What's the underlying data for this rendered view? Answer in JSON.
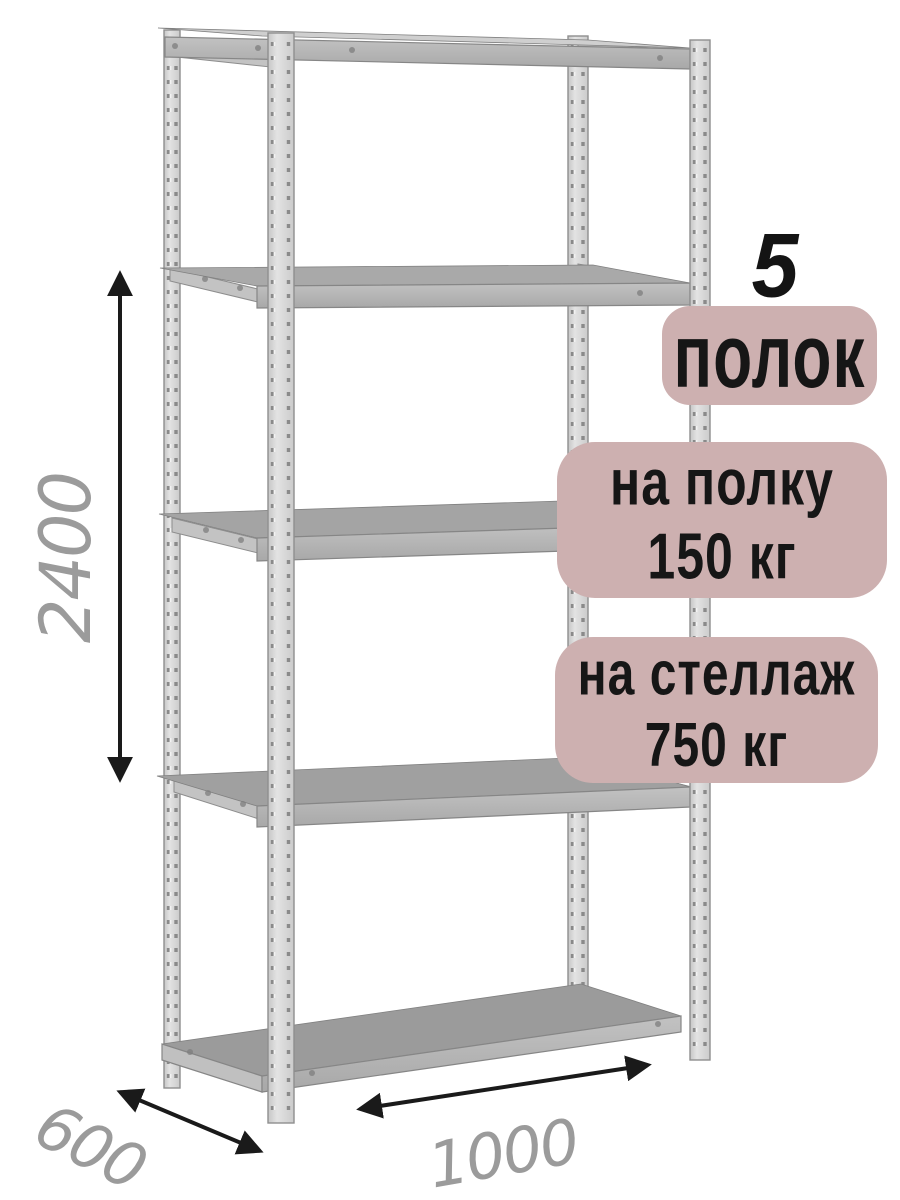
{
  "page": {
    "background": "#ffffff",
    "kind": "product-dimension-illustration"
  },
  "illustration": {
    "subject": "metal-shelving-rack",
    "shelf_count": 5,
    "metal_light": "#d9d9d9",
    "metal_mid": "#b4b4b4",
    "metal_dark": "#8f8f8f"
  },
  "badges": {
    "bg_color": "#cdb0b0",
    "text_color": "#161616",
    "count": {
      "number": "5",
      "label": "полок"
    },
    "shelf_load": {
      "line1": "на полку",
      "line2": "150 кг"
    },
    "rack_load": {
      "line1": "на стеллаж",
      "line2": "750 кг"
    }
  },
  "dimensions": {
    "label_color": "#9b9b9b",
    "arrow_color": "#1a1a1a",
    "height_mm": "2400",
    "depth_mm": "600",
    "width_mm": "1000"
  }
}
